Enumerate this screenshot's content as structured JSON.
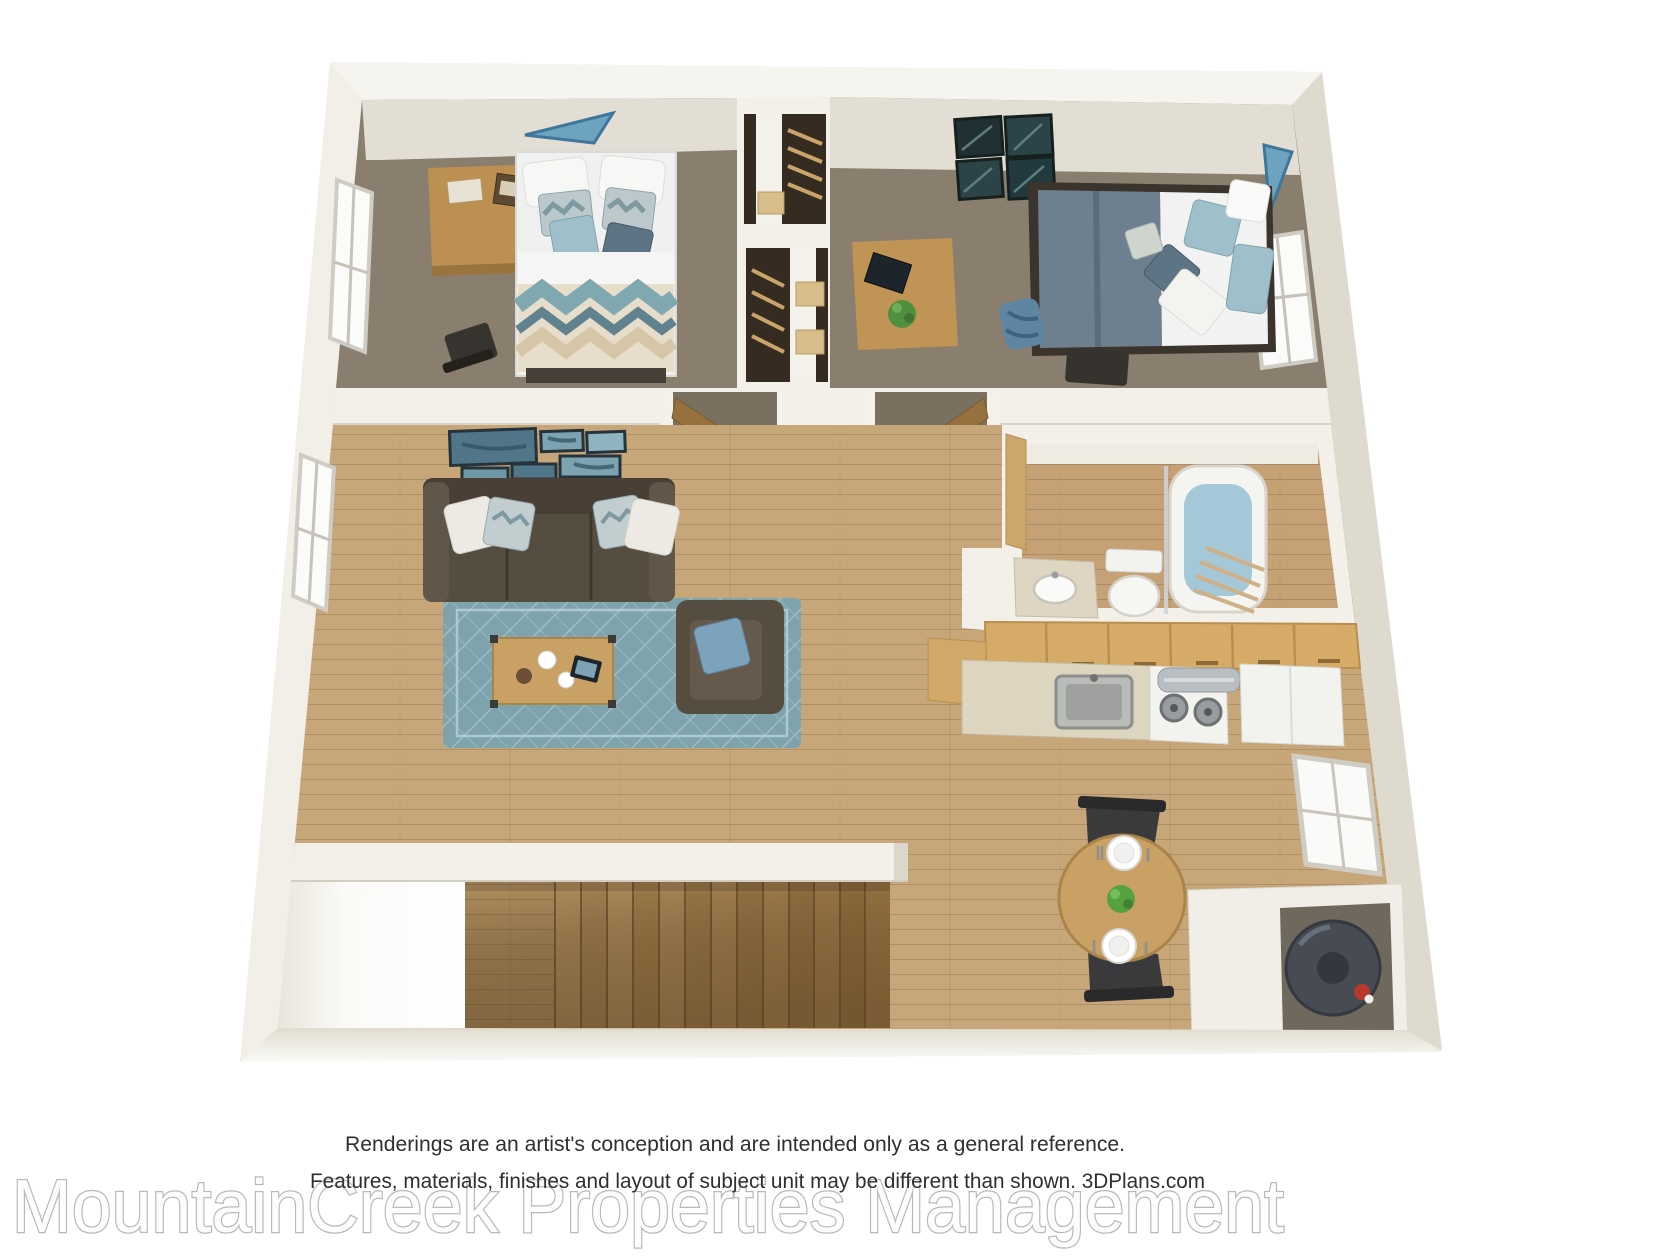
{
  "image": {
    "width": 1680,
    "height": 1260,
    "background": "#ffffff",
    "type": "3d-floor-plan-rendering"
  },
  "disclaimer": {
    "line1": "Renderings are an artist's conception and are intended only as a general reference.",
    "line2": "Features, materials, finishes and layout of subject unit may be different than shown. 3DPlans.com"
  },
  "watermark": {
    "text": "MountainCreek Properties Management"
  },
  "branding": {
    "plans_site": "3DPlans.com"
  },
  "palette": {
    "wall": "#e9e5da",
    "wall_top": "#f6f4ee",
    "wall_light": "#f3f0e9",
    "wall_dark": "#dedacd",
    "carpet": "#8a7e6e",
    "carpet_dark": "#7a7060",
    "wood_floor": "#c7a77a",
    "wood_light": "#c7a176",
    "plank_line": "#a8875c",
    "rug": "#7ea3ad",
    "rug_pattern": "#a5c3ca",
    "sofa": "#564d41",
    "sofa_dark": "#493f35",
    "cabinet_wood": "#d6ab67",
    "table_wood": "#c9a164",
    "desk_wood": "#bc9051",
    "stairs_wood": "#b3905f",
    "accent_teal": "#6ea3c0",
    "pillow_teal": "#9fc0cb",
    "duvet_slate": "#6e8090",
    "water_heater": "#464b54",
    "tub_water": "#a5c8d8",
    "appliance_white": "#f2f2ef",
    "text_dark": "#2f2f2f",
    "watermark_gray": "#b9b9b9"
  },
  "scene": {
    "rooms": [
      "bedroom-1",
      "closets",
      "bedroom-2",
      "living-room",
      "bathroom",
      "kitchen",
      "dining-area",
      "staircase",
      "water-heater-closet"
    ],
    "furniture": [
      "bed",
      "desk",
      "chair",
      "sofa",
      "armchair",
      "coffee-table",
      "area-rug",
      "wall-art",
      "toilet",
      "vanity-sink",
      "bathtub",
      "kitchen-sink",
      "stove",
      "range-hood",
      "refrigerator",
      "dining-table",
      "dining-chairs",
      "water-heater",
      "backpack",
      "houseplant"
    ]
  }
}
